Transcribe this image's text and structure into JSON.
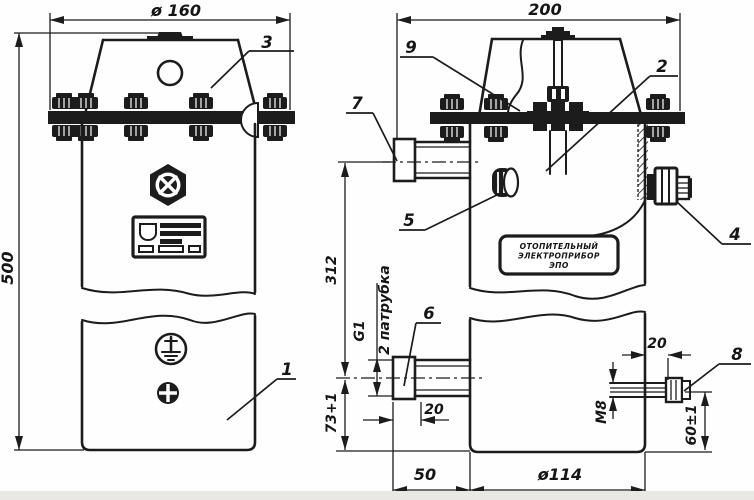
{
  "drawing": {
    "kind": "technical-drawing",
    "nameplate": {
      "line1": "ОТОПИТЕЛЬНЫЙ",
      "line2": "ЭЛЕКТРОПРИБОР",
      "line3": "ЭПО"
    },
    "dimensions": {
      "flange_diameter": "ø 160",
      "overall_height": "500",
      "overall_width": "200",
      "pipe_spacing": "312",
      "lower_pipe_height": "73+1",
      "pipe_thread": "G1",
      "pipe_note": "2 патрубка",
      "pipe_offset": "20",
      "pipe_stub_length": "50",
      "body_diameter": "ø114",
      "bolt_length": "20",
      "bolt_thread": "M8",
      "bolt_height": "60±1"
    },
    "part_labels": {
      "p1": "1",
      "p2": "2",
      "p3": "3",
      "p4": "4",
      "p5": "5",
      "p6": "6",
      "p7": "7",
      "p8": "8",
      "p9": "9"
    }
  },
  "colors": {
    "line": "#1c1c1c",
    "background": "#fefefe",
    "footer_strip": "#eae8e4"
  }
}
